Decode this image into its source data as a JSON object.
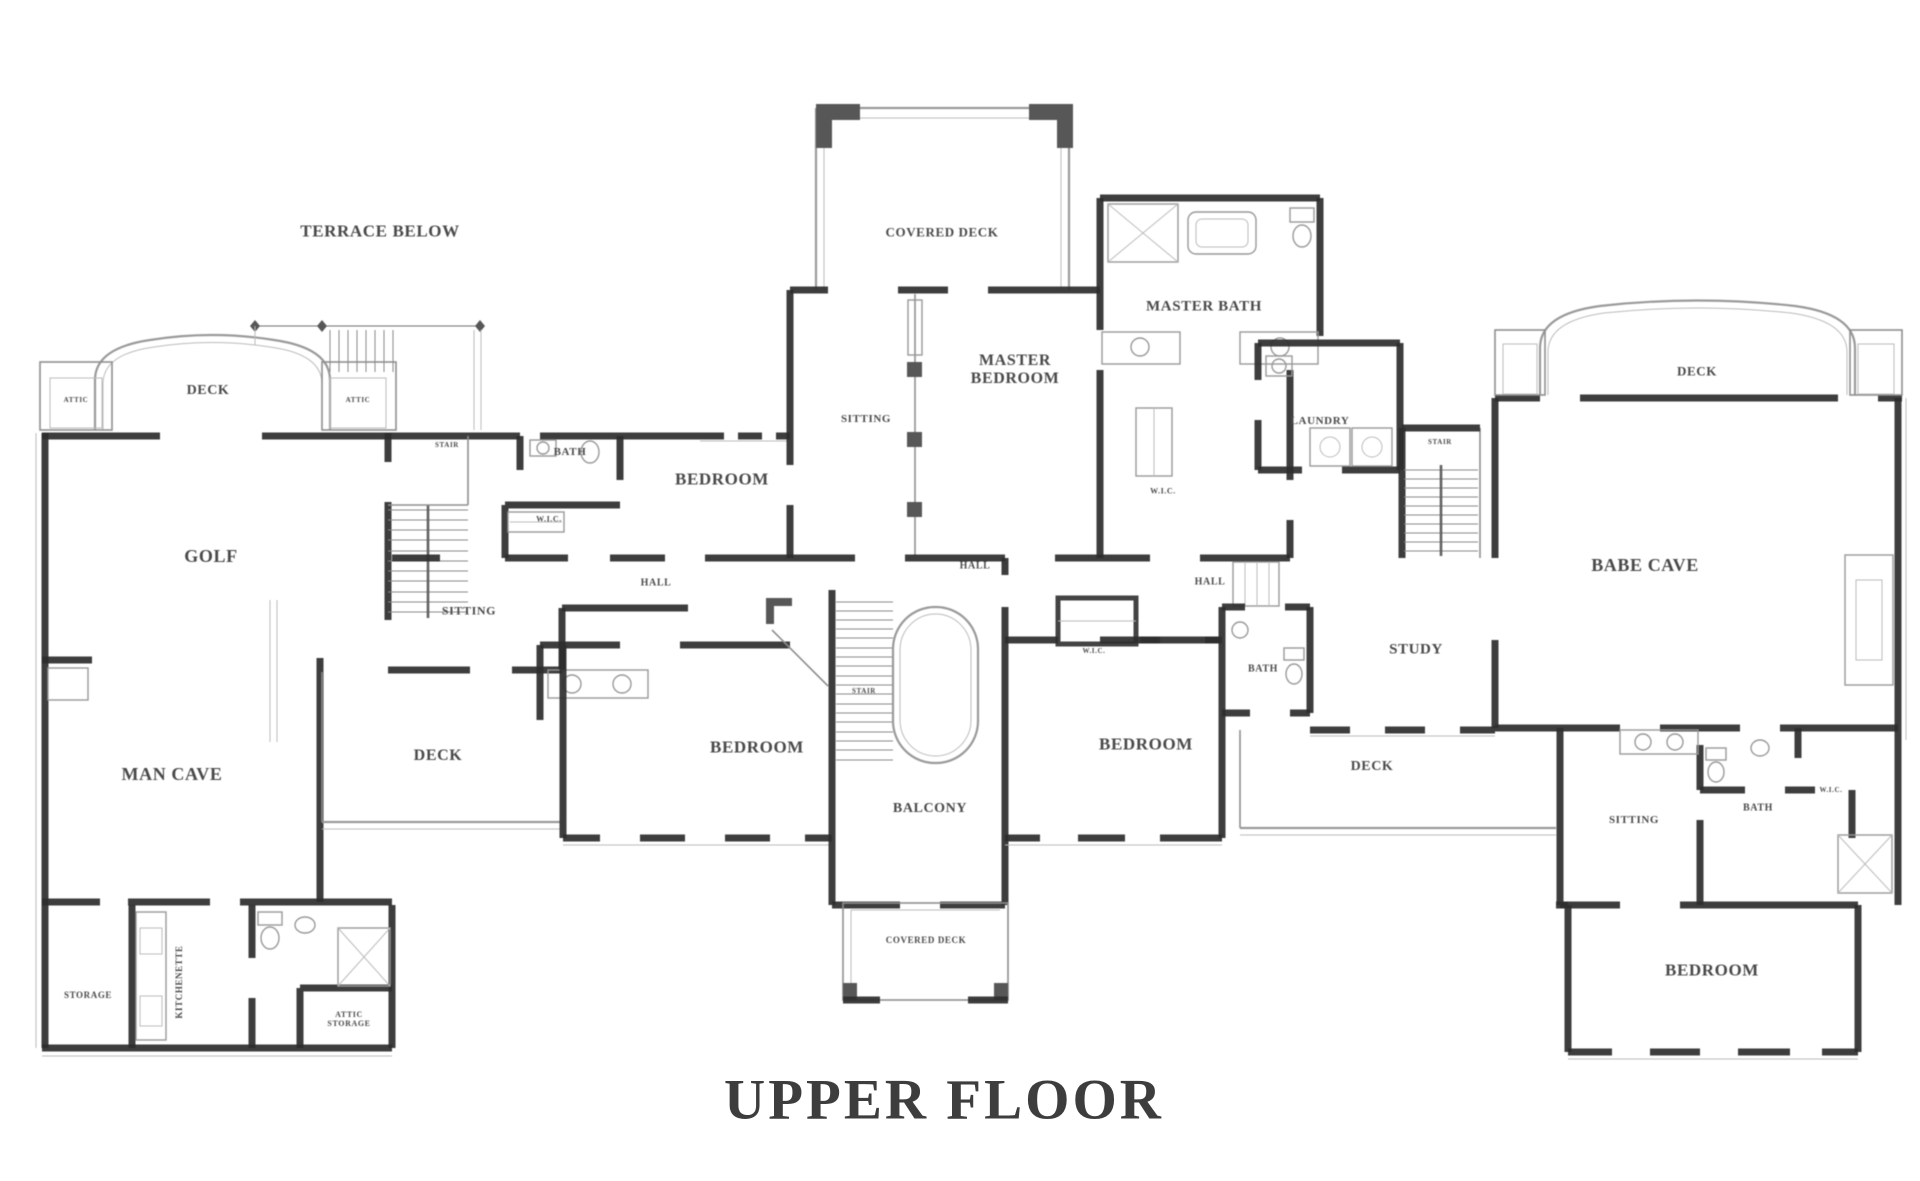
{
  "title": "UPPER FLOOR",
  "colors": {
    "wall": "#2b2b2b",
    "thin_line": "#8f8f8f",
    "label_text": "#474747",
    "background": "#ffffff"
  },
  "plan": {
    "labels": [
      {
        "id": "label-terrace-below",
        "text": "TERRACE BELOW",
        "x": 380,
        "y": 231,
        "fs": 17
      },
      {
        "id": "label-deck-top-left",
        "text": "DECK",
        "x": 208,
        "y": 391,
        "fs": 14
      },
      {
        "id": "label-attic-left",
        "text": "ATTIC",
        "x": 76,
        "y": 401,
        "fs": 7
      },
      {
        "id": "label-attic-right",
        "text": "ATTIC",
        "x": 358,
        "y": 401,
        "fs": 7
      },
      {
        "id": "label-golf",
        "text": "GOLF",
        "x": 211,
        "y": 556,
        "fs": 18
      },
      {
        "id": "label-stair-left",
        "text": "STAIR",
        "x": 447,
        "y": 446,
        "fs": 7
      },
      {
        "id": "label-bath-left",
        "text": "BATH",
        "x": 570,
        "y": 452,
        "fs": 11
      },
      {
        "id": "label-wic-left",
        "text": "W.I.C.",
        "x": 549,
        "y": 520,
        "fs": 8
      },
      {
        "id": "label-bedroom-top-left",
        "text": "BEDROOM",
        "x": 722,
        "y": 479,
        "fs": 17
      },
      {
        "id": "label-hall-left",
        "text": "HALL",
        "x": 656,
        "y": 583,
        "fs": 10
      },
      {
        "id": "label-sitting-left",
        "text": "SITTING",
        "x": 469,
        "y": 611,
        "fs": 12
      },
      {
        "id": "label-man-cave",
        "text": "MAN CAVE",
        "x": 172,
        "y": 774,
        "fs": 18
      },
      {
        "id": "label-deck-left-middle",
        "text": "DECK",
        "x": 438,
        "y": 756,
        "fs": 16
      },
      {
        "id": "label-bedroom-center-left",
        "text": "BEDROOM",
        "x": 757,
        "y": 747,
        "fs": 17
      },
      {
        "id": "label-stair-center",
        "text": "STAIR",
        "x": 864,
        "y": 692,
        "fs": 7
      },
      {
        "id": "label-balcony",
        "text": "BALCONY",
        "x": 930,
        "y": 809,
        "fs": 14
      },
      {
        "id": "label-covered-deck-bottom",
        "text": "COVERED DECK",
        "x": 926,
        "y": 940,
        "fs": 9
      },
      {
        "id": "label-covered-deck-top",
        "text": "COVERED DECK",
        "x": 942,
        "y": 233,
        "fs": 13
      },
      {
        "id": "label-sitting-master",
        "text": "SITTING",
        "x": 866,
        "y": 419,
        "fs": 11
      },
      {
        "id": "label-master-bedroom",
        "text": "MASTER\nBEDROOM",
        "x": 1015,
        "y": 370,
        "fs": 16
      },
      {
        "id": "label-master-bath",
        "text": "MASTER BATH",
        "x": 1204,
        "y": 307,
        "fs": 15
      },
      {
        "id": "label-wic-master",
        "text": "W.I.C.",
        "x": 1163,
        "y": 492,
        "fs": 8
      },
      {
        "id": "label-hall-center",
        "text": "HALL",
        "x": 975,
        "y": 566,
        "fs": 10
      },
      {
        "id": "label-hall-right",
        "text": "HALL",
        "x": 1210,
        "y": 582,
        "fs": 10
      },
      {
        "id": "label-laundry",
        "text": "LAUNDRY",
        "x": 1320,
        "y": 421,
        "fs": 11
      },
      {
        "id": "label-stair-right",
        "text": "STAIR",
        "x": 1440,
        "y": 443,
        "fs": 7
      },
      {
        "id": "label-wic-center-right",
        "text": "W.I.C.",
        "x": 1094,
        "y": 652,
        "fs": 7
      },
      {
        "id": "label-bath-center-right",
        "text": "BATH",
        "x": 1263,
        "y": 669,
        "fs": 10
      },
      {
        "id": "label-bedroom-center-right",
        "text": "BEDROOM",
        "x": 1146,
        "y": 744,
        "fs": 17
      },
      {
        "id": "label-study",
        "text": "STUDY",
        "x": 1416,
        "y": 650,
        "fs": 15
      },
      {
        "id": "label-deck-right-middle",
        "text": "DECK",
        "x": 1372,
        "y": 767,
        "fs": 14
      },
      {
        "id": "label-deck-top-right",
        "text": "DECK",
        "x": 1697,
        "y": 372,
        "fs": 13
      },
      {
        "id": "label-babe-cave",
        "text": "BABE CAVE",
        "x": 1645,
        "y": 565,
        "fs": 18
      },
      {
        "id": "label-sitting-right",
        "text": "SITTING",
        "x": 1634,
        "y": 820,
        "fs": 11
      },
      {
        "id": "label-bath-right",
        "text": "BATH",
        "x": 1758,
        "y": 808,
        "fs": 10
      },
      {
        "id": "label-wic-right",
        "text": "W.I.C.",
        "x": 1831,
        "y": 791,
        "fs": 7
      },
      {
        "id": "label-bedroom-bottom-right",
        "text": "BEDROOM",
        "x": 1712,
        "y": 970,
        "fs": 17
      },
      {
        "id": "label-storage",
        "text": "STORAGE",
        "x": 88,
        "y": 995,
        "fs": 9
      },
      {
        "id": "label-kitchenette",
        "text": "KITCHENETTE",
        "x": 179,
        "y": 982,
        "fs": 9,
        "rot": true
      },
      {
        "id": "label-attic-storage",
        "text": "ATTIC\nSTORAGE",
        "x": 349,
        "y": 1020,
        "fs": 8
      }
    ]
  }
}
